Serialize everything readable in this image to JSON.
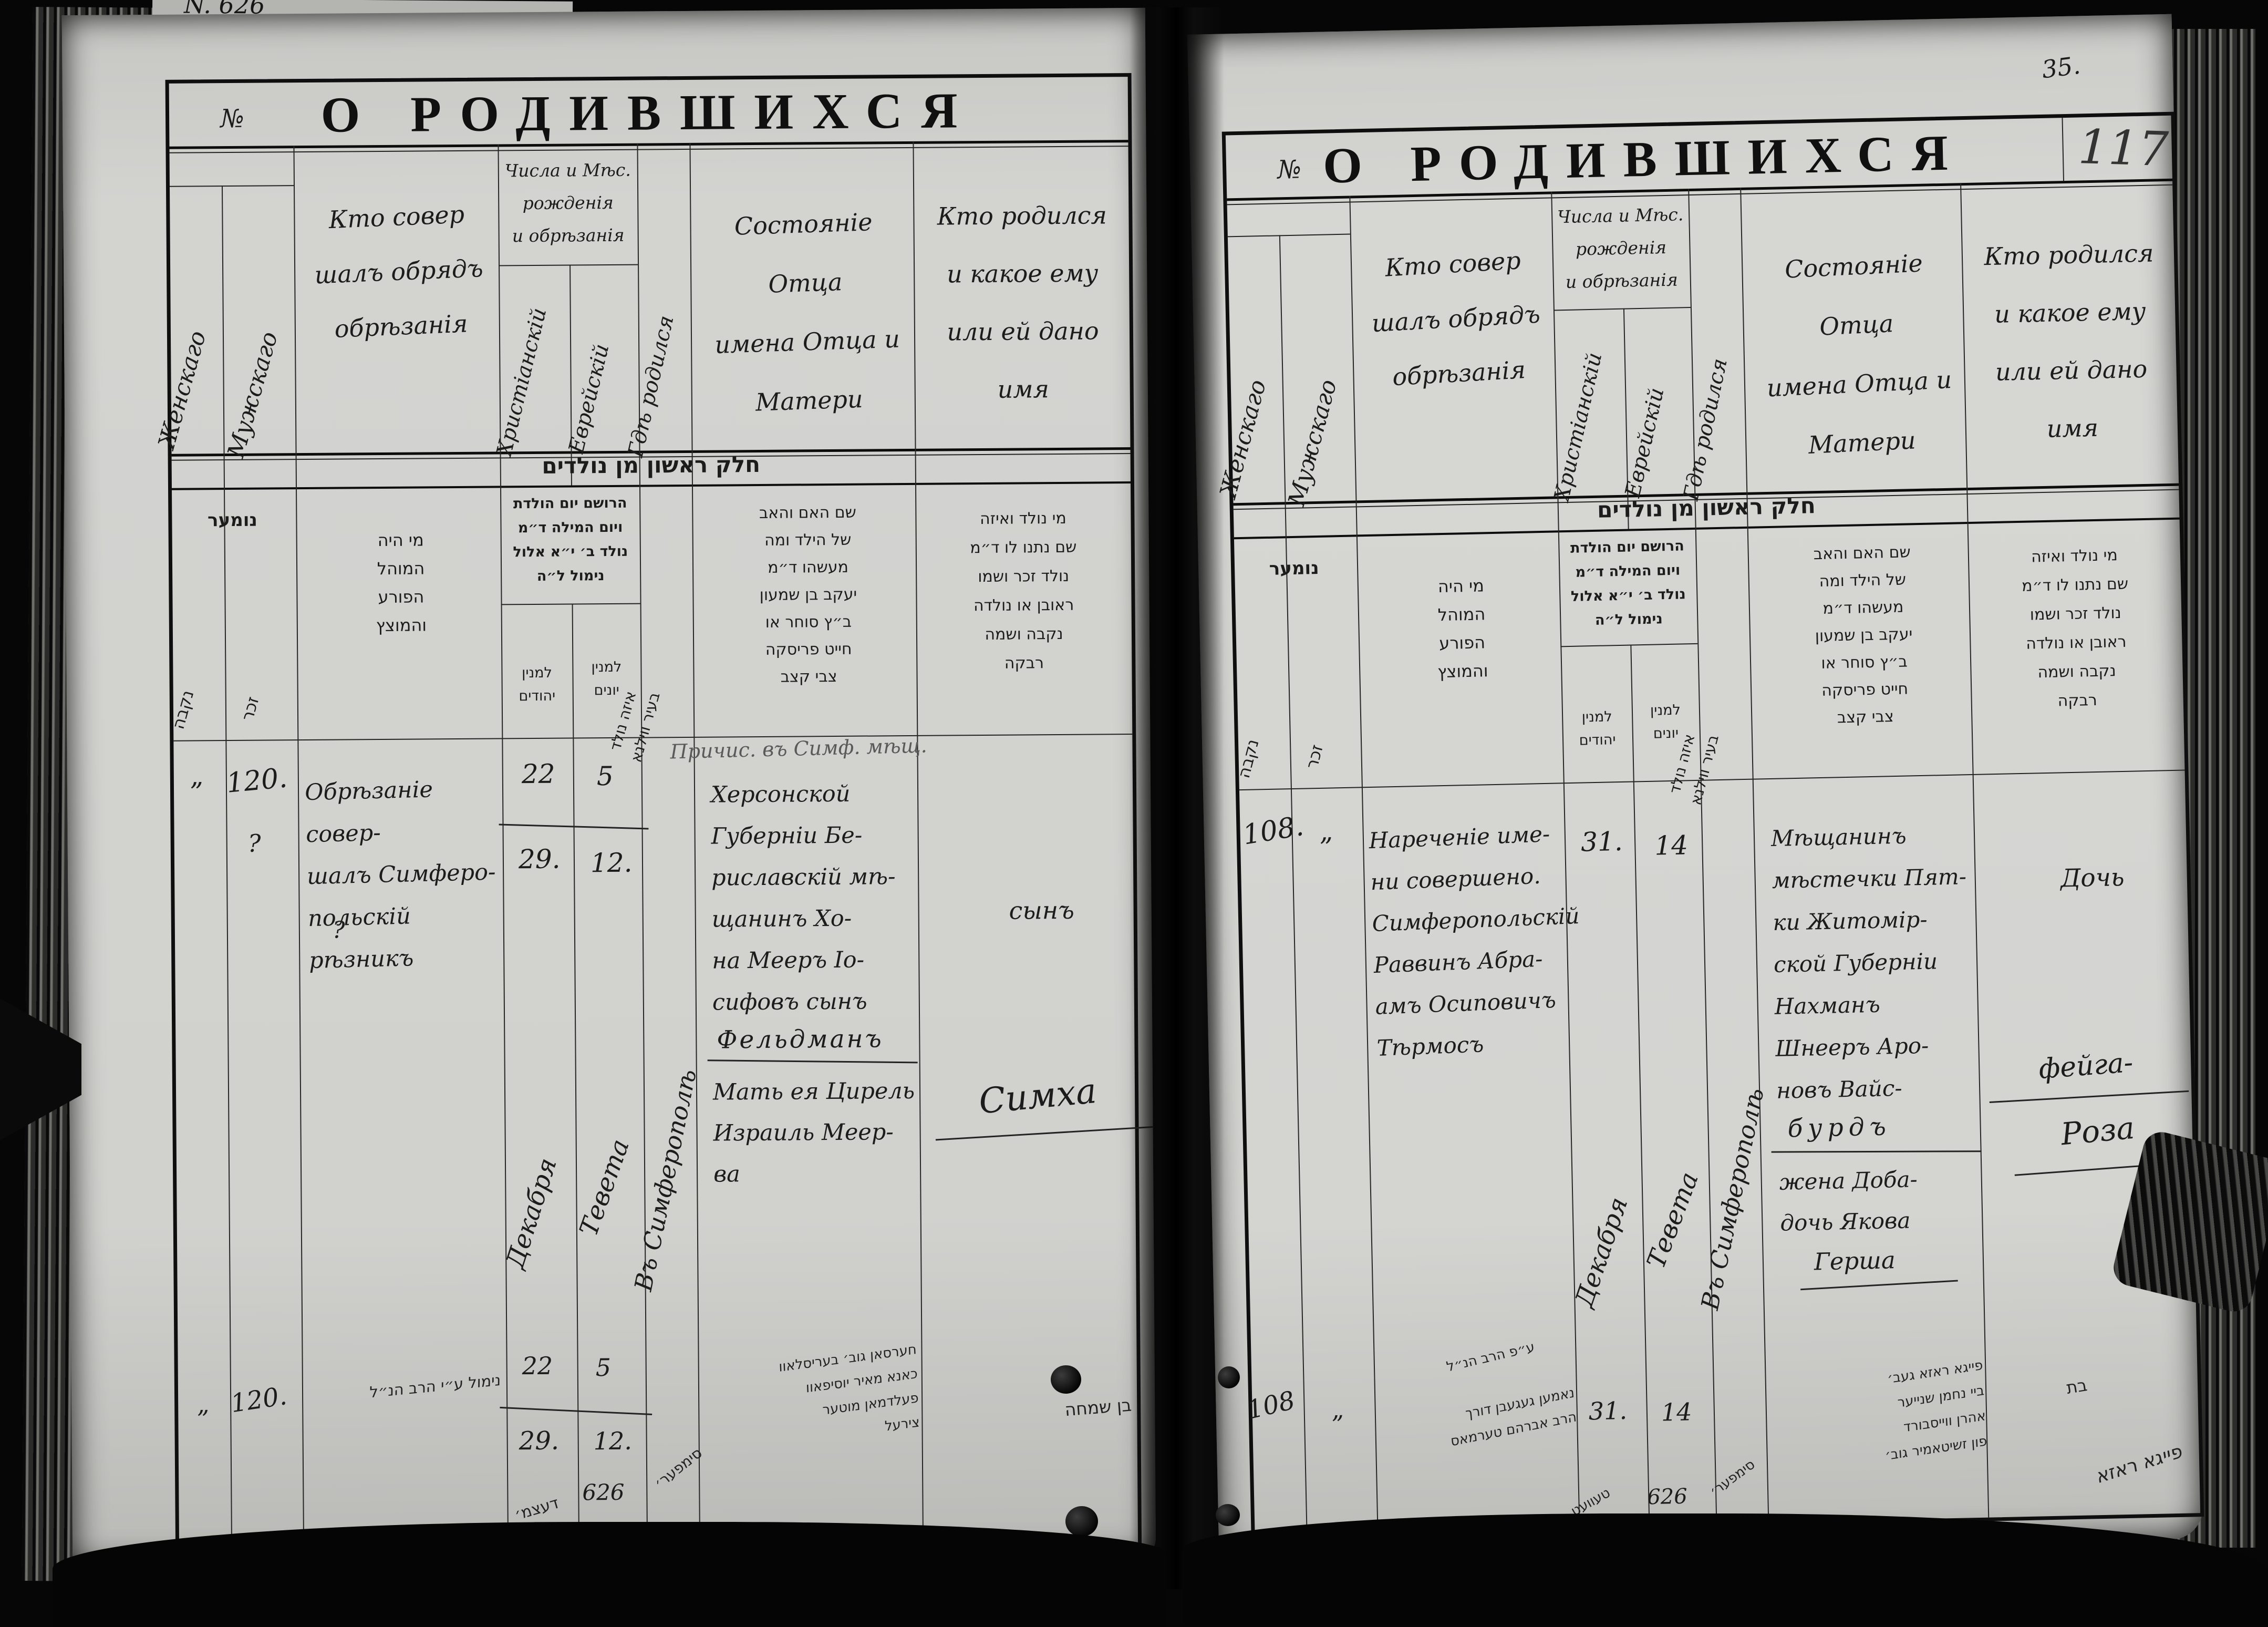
{
  "margin": {
    "top_left_note": "N. 626",
    "folio": "35.",
    "pencil_folio": "117"
  },
  "title": "О РОДИВШИХСЯ",
  "ru": {
    "num": "№",
    "female": "Женскаго",
    "male": "Мужскаго",
    "who": "Кто совер\nшалъ обрядъ\nобрѣзанія",
    "dates": "Числа и Мѣс.\nрожденія\nи обрѣзанія",
    "christian": "Христіанскій",
    "jewish": "Еврейскій",
    "where": "Гдѣ родился",
    "father": "Состояніе Отца\nимена Отца и\nМатери",
    "child": "Кто родился\nи какое ему\nили ей дано имя"
  },
  "he": {
    "band": "חלק ראשון מן נולדים",
    "num": "נומער",
    "female": "נקבה",
    "male": "זכר",
    "who": "מי היה\nהמוהל\nהפורע\nוהמוצץ",
    "dates": "הרושם יום הולדת\nויום המילה ד״מ\nנולד ב׳ י״א אלול\nנימול ל״ה",
    "cal_jewish": "למנין\nיהודים",
    "cal_greek": "למנין\nיונים",
    "where": "איזה נולד\nבעיר ווילנא",
    "father": "שם האם והאב\nשל הילד ומה\nמעשהו ד״מ\nיעקב בן שמעון\nב״ץ סוחר או\nחייט פריסקה\nצבי קצב",
    "child": "מי נולד ואיזה\nשם נתנו לו ד״מ\nנולד זכר ושמו\nראובן או נולדה\nנקבה ושמה\nרבקה"
  },
  "records": {
    "left": {
      "tally": "”",
      "number": "120.",
      "q1": "?",
      "q2": "?",
      "who": "Обрѣзаніе совер-\nшалъ Симферо-\nпольскій рѣзникъ",
      "d_chr_1": "22",
      "d_chr_2": "29.",
      "d_jew_1": "5",
      "d_jew_2": "12.",
      "month_chr": "Декабря",
      "month_jew": "Тевета",
      "where": "Въ Симферополѣ",
      "note": "Причис. въ Симф. мѣщ.",
      "father": "Херсонской\nГуберніи Бе-\nриславскій мѣ-\nщанинъ Хо-\nна Мееръ Іо-\nсифовъ сынъ",
      "father_surname": "Фельдманъ",
      "mother": "Мать ея Цирель\nИзраиль Меер-\nва",
      "child_rel": "сынъ",
      "child_name": "Симха"
    },
    "left_heb": {
      "tally": "”",
      "number": "120.",
      "who": "נימול ע״י הרב הנ״ל",
      "d_chr_1": "22",
      "d_chr_2": "29.",
      "d_jew_1": "5",
      "d_jew_2": "12.",
      "year": "626",
      "month": "דעצמ׳",
      "where": "סימפער׳",
      "father": "חערסאן גוב׳ בעריסלאוו\nכאנא מאיר יוסיפאוו\nפעלדמאן מוטער\nצירעל",
      "child": "בן שמחה"
    },
    "right": {
      "number": "108.",
      "tally": "”",
      "who": "Нареченіе име-\nни совершено.\nСимферопольскій\nРаввинъ Абра-\nамъ Осиповичъ\nТѣрмосъ",
      "d_chr": "31.",
      "d_jew": "14",
      "month_chr": "Декабря",
      "month_jew": "Тевета",
      "where": "Въ Симферополѣ",
      "father": "Мѣщанинъ\nмѣстечки Пят-\nки Житомір-\nской Губерніи\nНахманъ\nШнееръ Аро-\nновъ Вайс-",
      "father_surname": "бурдъ",
      "mother": "жена Доба-\nдочь Якова",
      "mother_father": "Герша",
      "child_rel": "Дочь",
      "child_name1": "фейга-",
      "child_name2": "Роза"
    },
    "right_heb": {
      "number": "108",
      "tally": "”",
      "who_note": "ע״פ הרב הנ״ל",
      "who": "נאמען געגעבן דורך\nהרב אברהם טערמאס",
      "d_chr": "31.",
      "d_jew": "14",
      "year": "626",
      "month": "טעוועט",
      "where": "סימפער׳",
      "father": "פייגא ראזא געב׳\nביי נחמן שנייער\nאהרן ווייסבורד\nפון זשיטאמיר גוב׳",
      "child1": "בת",
      "child2": "פייגא ראזא"
    }
  }
}
